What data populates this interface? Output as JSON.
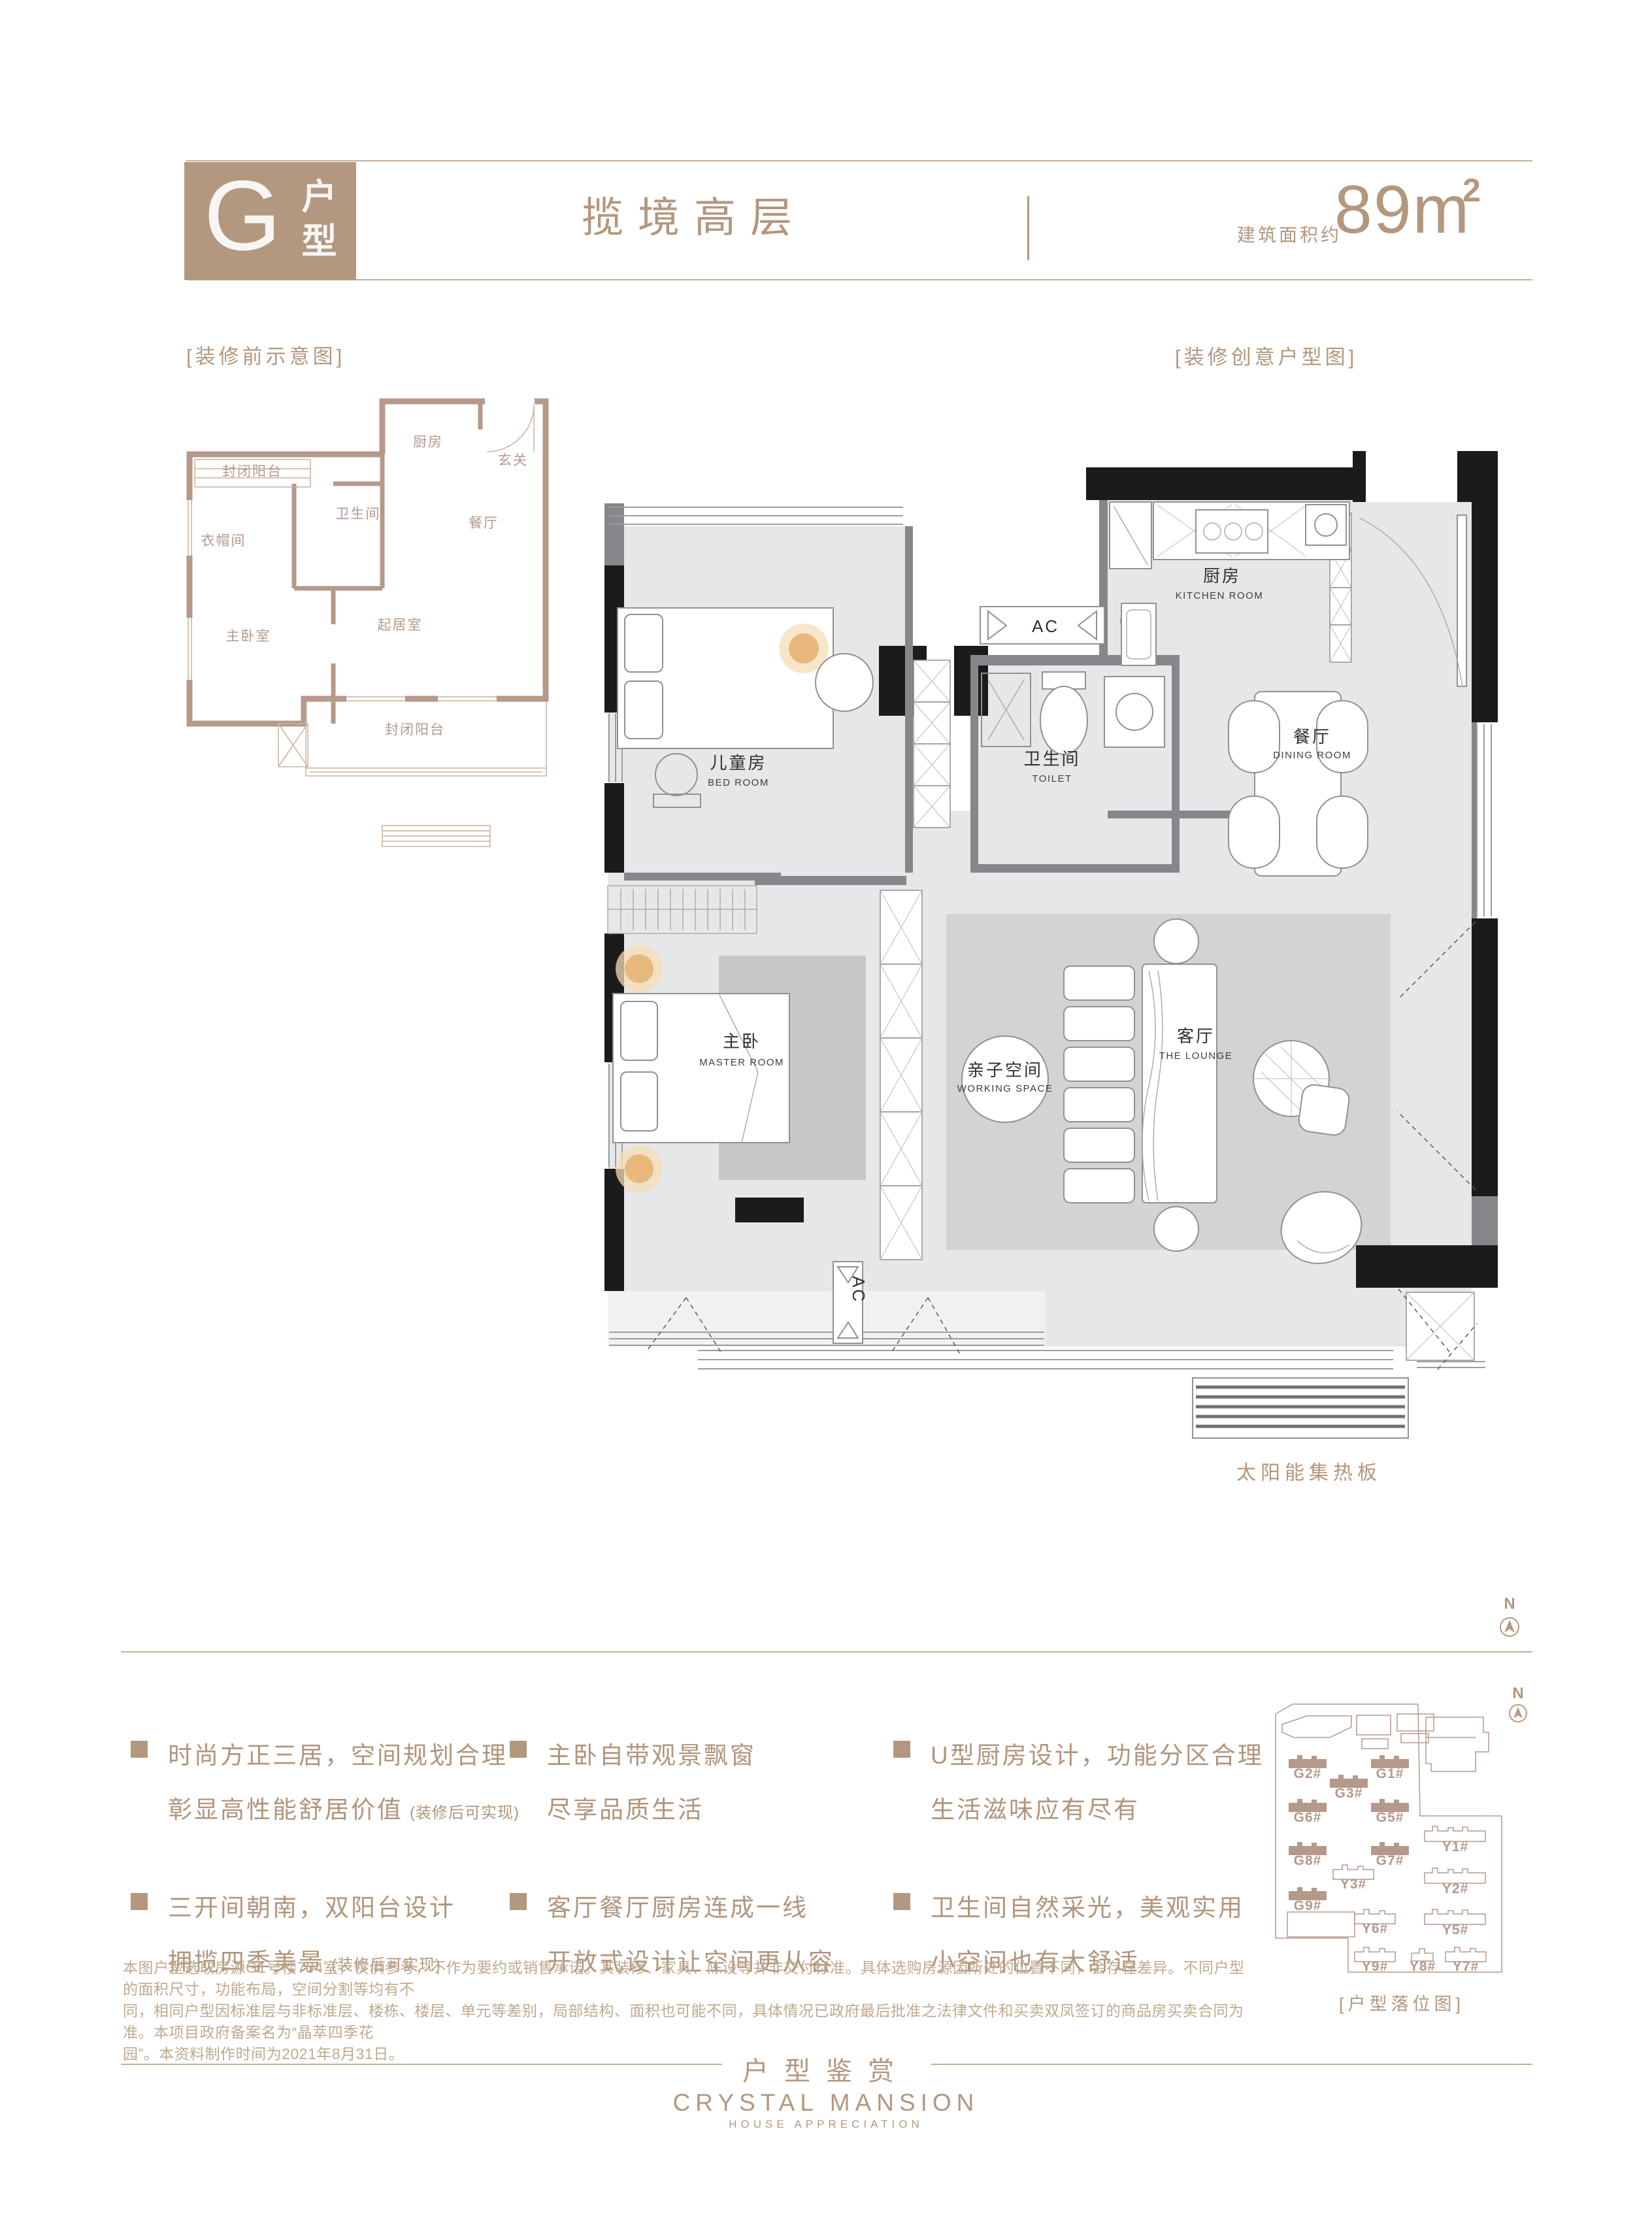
{
  "header": {
    "type_letter": "G",
    "type_label": "户型",
    "title": "揽境高层",
    "area_prefix": "建筑面积约",
    "area_value": "89m",
    "area_sup": "2"
  },
  "labels": {
    "before_plan": "[装修前示意图]",
    "creative_plan": "[装修创意户型图]",
    "site_plan": "[户型落位图]",
    "solar": "太阳能集热板",
    "compass_n": "N"
  },
  "small_plan": {
    "balcony_top": "封闭阳台",
    "kitchen": "厨房",
    "foyer": "玄关",
    "bathroom": "卫生间",
    "cloakroom": "衣帽间",
    "dining": "餐厅",
    "master": "主卧室",
    "living": "起居室",
    "balcony_bottom": "封闭阳台"
  },
  "large_plan": {
    "bedroom_cn": "儿童房",
    "bedroom_en": "BED ROOM",
    "toilet_cn": "卫生间",
    "toilet_en": "TOILET",
    "kitchen_cn": "厨房",
    "kitchen_en": "KITCHEN ROOM",
    "dining_cn": "餐厅",
    "dining_en": "DINING ROOM",
    "master_cn": "主卧",
    "master_en": "MASTER ROOM",
    "working_cn": "亲子空间",
    "working_en": "WORKING SPACE",
    "lounge_cn": "客厅",
    "lounge_en": "THE LOUNGE",
    "ac": "AC"
  },
  "features": [
    {
      "line1": "时尚方正三居，空间规划合理",
      "line2": "彰显高性能舒居价值",
      "note": "(装修后可实现)"
    },
    {
      "line1": "三开间朝南，双阳台设计",
      "line2": "拥揽四季美景",
      "note": "(装修后可实现)"
    },
    {
      "line1": "主卧自带观景飘窗",
      "line2": "尽享品质生活",
      "note": ""
    },
    {
      "line1": "客厅餐厅厨房连成一线",
      "line2": "开放式设计让空间更从容",
      "note": ""
    },
    {
      "line1": "U型厨房设计，功能分区合理",
      "line2": "生活滋味应有尽有",
      "note": ""
    },
    {
      "line1": "卫生间自然采光，美观实用",
      "line2": "小空间也有大舒适",
      "note": ""
    }
  ],
  "site_plan": {
    "buildings": [
      {
        "label": "G2#"
      },
      {
        "label": "G1#"
      },
      {
        "label": "G3#"
      },
      {
        "label": "G6#"
      },
      {
        "label": "G5#"
      },
      {
        "label": "G8#"
      },
      {
        "label": "G7#"
      },
      {
        "label": "G9#"
      },
      {
        "label": "Y1#"
      },
      {
        "label": "Y2#"
      },
      {
        "label": "Y3#"
      },
      {
        "label": "Y5#"
      },
      {
        "label": "Y6#"
      },
      {
        "label": "Y7#"
      },
      {
        "label": "Y8#"
      },
      {
        "label": "Y9#"
      }
    ]
  },
  "disclaimer": [
    "本图户型选取房源G1号楼704室，仅供参考，不作为要约或销售承诺。其装修、家具、陈设等并非交付标准。具体选购房源因所处的位置不同，会存在差异。不同户型的面积尺寸，功能布局，空间分割等均有不",
    "同，相同户型因标准层与非标准层、楼栋、楼层、单元等差别，局部结构、面积也可能不同，具体情况已政府最后批准之法律文件和买卖双凤签订的商品房买卖合同为准。本项目政府备案名为“晶萃四季花",
    "园”。本资料制作时间为2021年8月31日。"
  ],
  "footer": {
    "cn": "户型鉴赏",
    "en": "CRYSTAL MANSION",
    "sub": "HOUSE APPRECIATION"
  }
}
